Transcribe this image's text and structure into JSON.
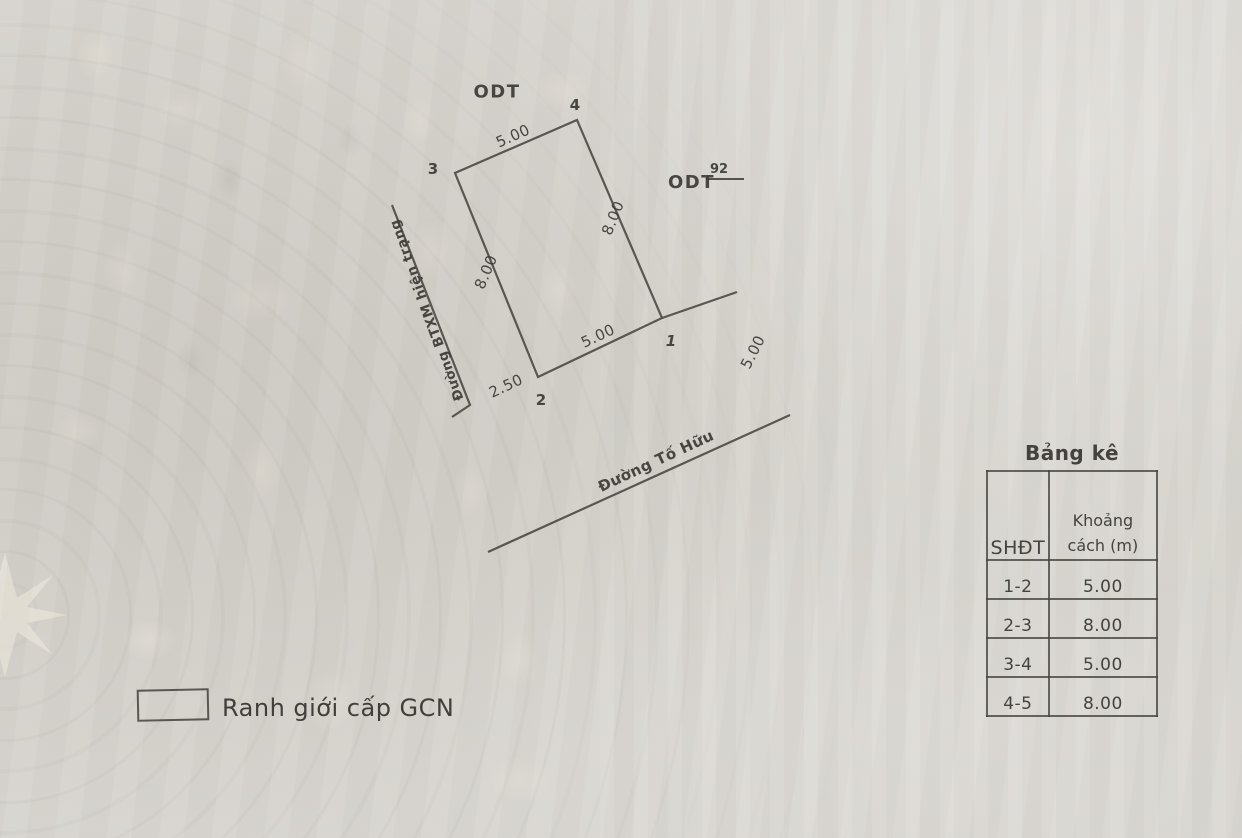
{
  "plan": {
    "zone_top": "ODT",
    "zone_right": "ODT",
    "zone_right_number": "92",
    "points": {
      "p1": "1",
      "p2": "2",
      "p3": "3",
      "p4": "4"
    },
    "dims": {
      "top": "5.00",
      "left": "8.00",
      "right": "8.00",
      "bottom": "5.00",
      "offset_left": "2.50",
      "offset_right": "5.00"
    },
    "road_left": "Đường BTXM hiện trạng",
    "road_bottom": "Đường Tố Hữu"
  },
  "legend": {
    "boundary_label": "Ranh giới cấp GCN"
  },
  "table": {
    "title": "Bảng kê",
    "col_shdt": "SHĐT",
    "col_distance": "Khoảng cách (m)",
    "rows": [
      {
        "id": "1-2",
        "d": "5.00"
      },
      {
        "id": "2-3",
        "d": "8.00"
      },
      {
        "id": "3-4",
        "d": "5.00"
      },
      {
        "id": "4-5",
        "d": "8.00"
      }
    ]
  },
  "colors": {
    "paper": "#d6d3ce",
    "ink": "#3c3a35",
    "line": "#48463f"
  }
}
